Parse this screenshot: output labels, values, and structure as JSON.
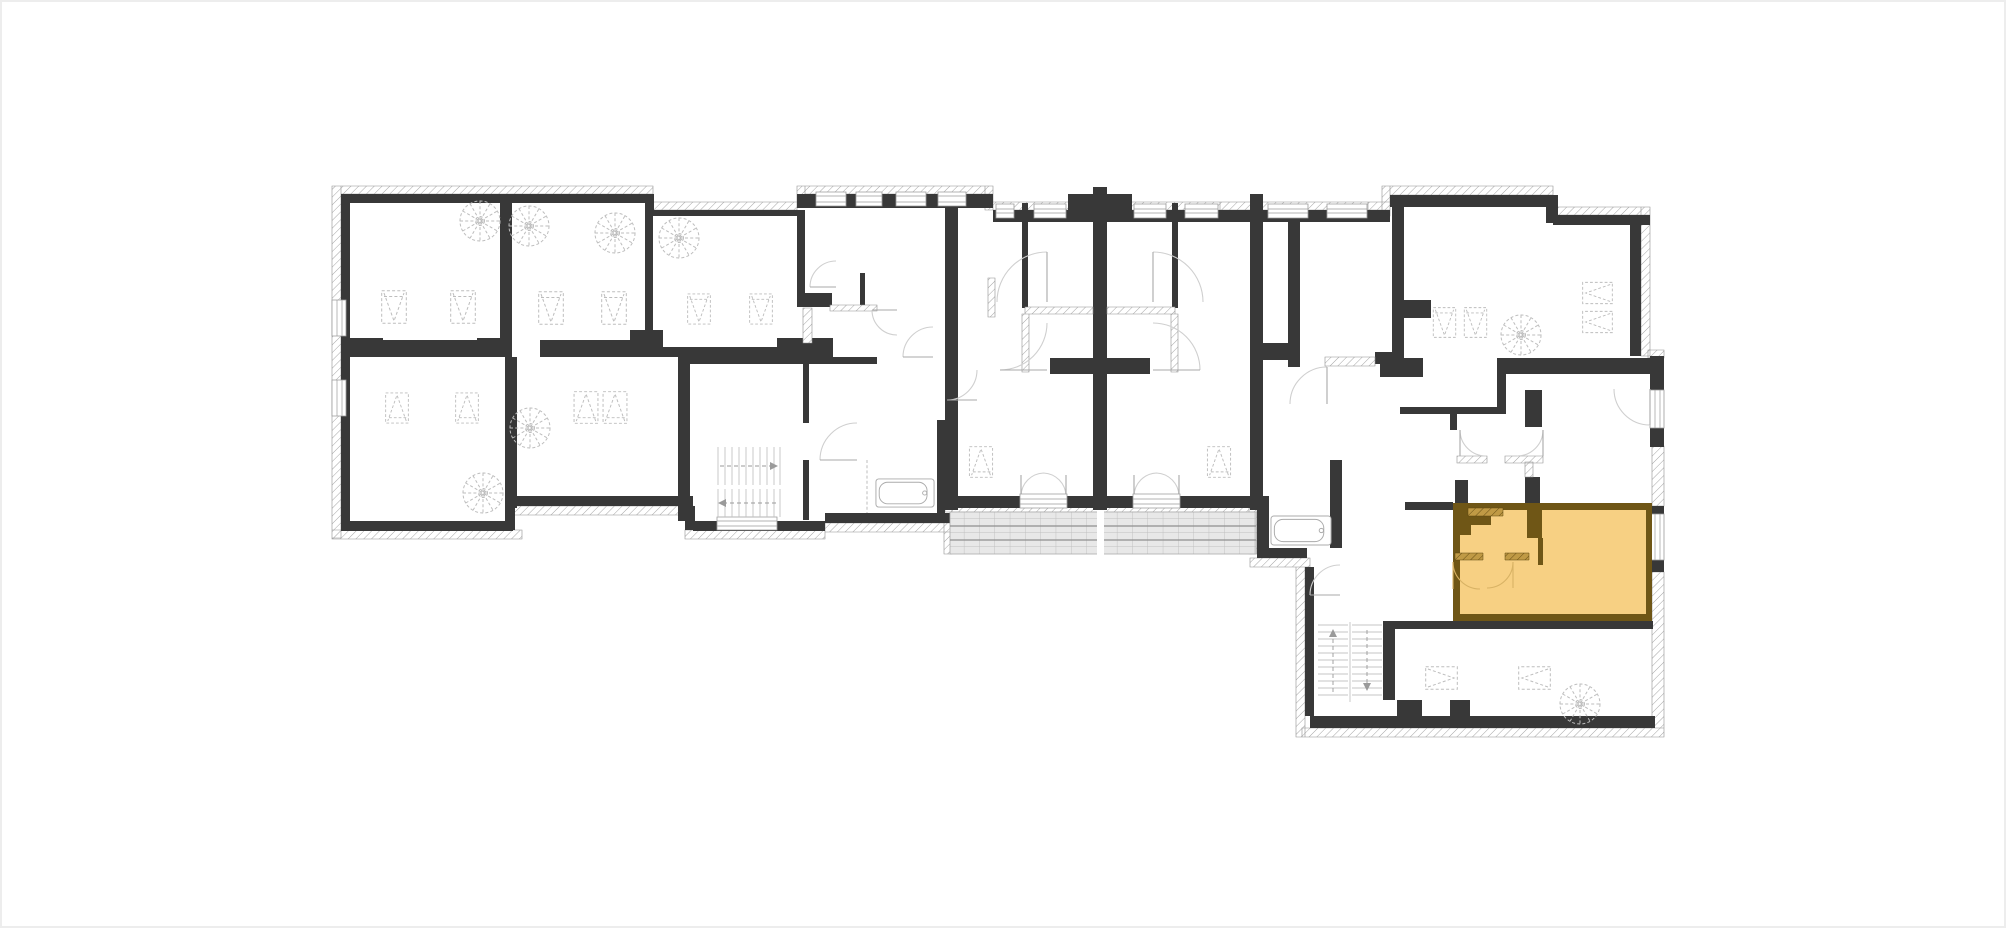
{
  "page": {
    "background": "#ffffff",
    "frame_border": "#ededed"
  },
  "plan": {
    "wall": "#383838",
    "hatch_line": "#9b9b9b",
    "hatch_edge": "#8f8f8f",
    "window_line": "#9b9b9b",
    "door_arc": "#cfcfcf",
    "door_leaf": "#a8a8a8",
    "furniture_line": "#bdbdbd",
    "stair_line": "#c4c4c4",
    "stair_arrow": "#9a9a9a",
    "tile_fill": "#e8e8e8",
    "tile_line": "#bfbfbf",
    "tile_accent": "#8f8f8f",
    "unit": {
      "fill": "#f7d083",
      "wall": "#6f5616",
      "hatch_fill": "#c09a45",
      "hatch_line": "#5f470f",
      "arc": "#d8b264"
    }
  }
}
